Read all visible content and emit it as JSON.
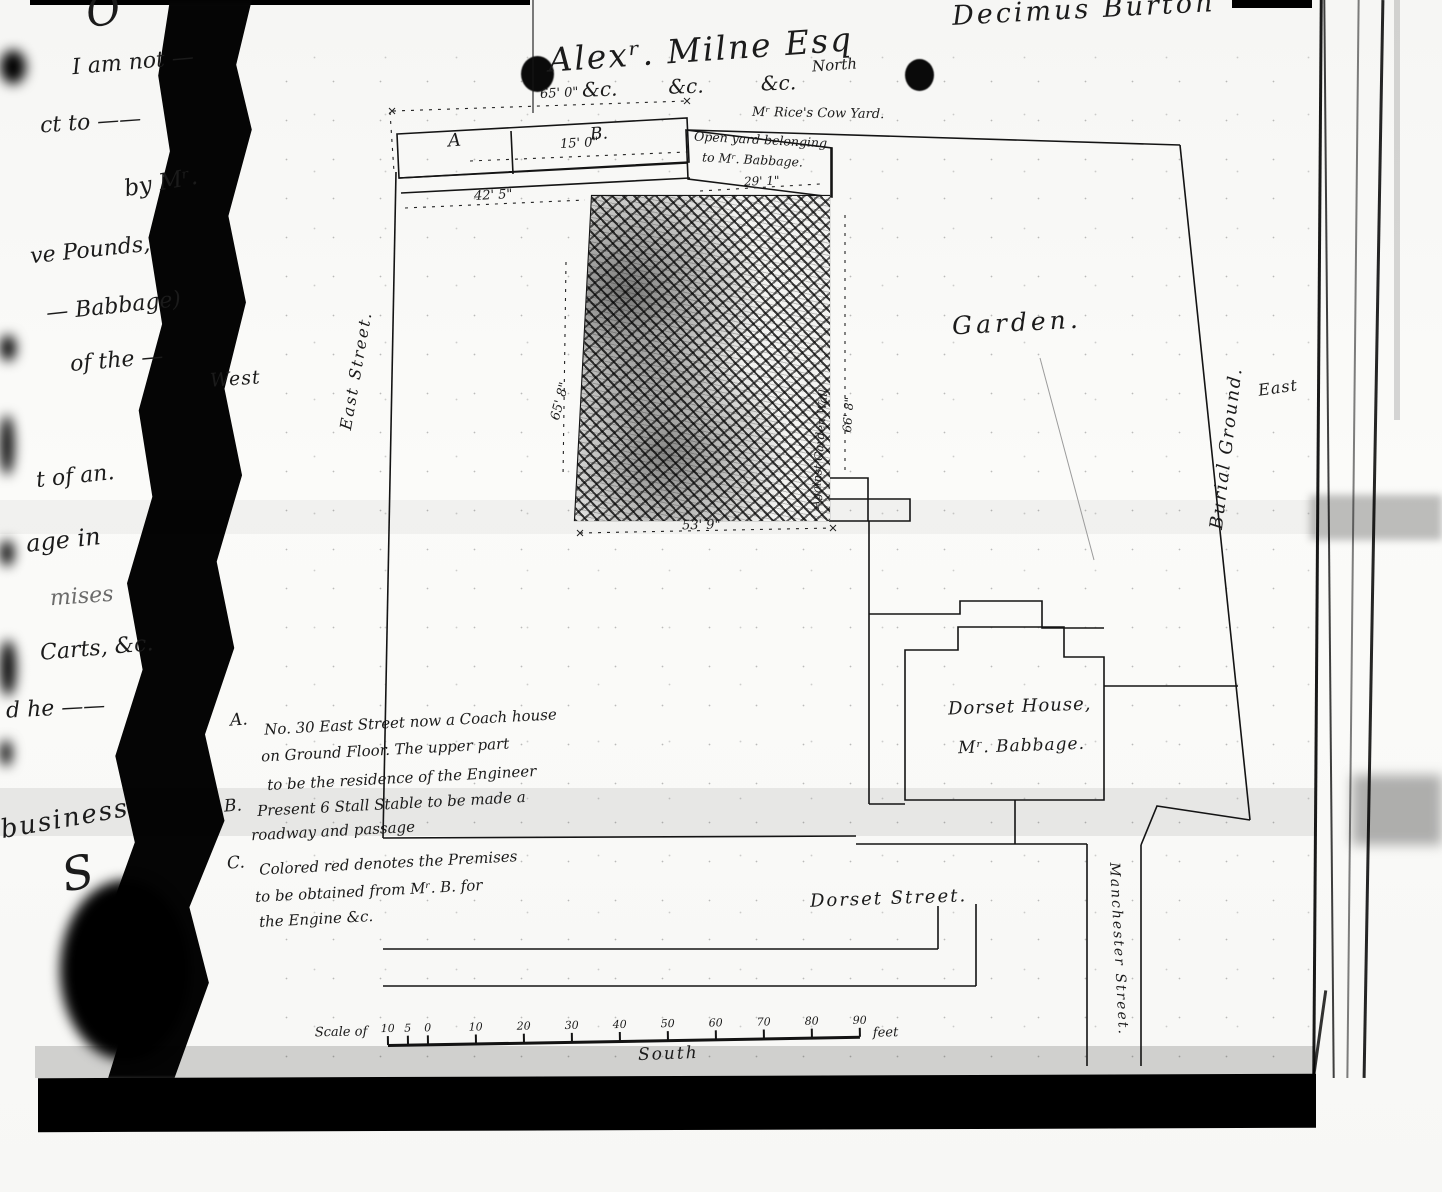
{
  "page": {
    "heading_name": "Alexʳ. Milne Esq",
    "heading_ditto": "&c.        &c.         &c.",
    "signature": "Decimus Burton",
    "compass": {
      "north": "North",
      "south": "South",
      "east": "East",
      "west": "West"
    }
  },
  "margin_letter": {
    "fragments": [
      "I am not —",
      "ct  to ——",
      "by  Mʳ.",
      "ve  Pounds,",
      "— Babbage)",
      "of  the —",
      "t  of an.",
      "age  in",
      "mises",
      "Carts, &c.",
      "d   he  ——",
      "business"
    ],
    "flourish_top": "O",
    "flourish_bottom": "S"
  },
  "plan": {
    "streets": {
      "east_street": "East Street.",
      "dorset_street": "Dorset Street.",
      "manchester_street": "Manchester Street."
    },
    "areas": {
      "cow_yard": "Mʳ Rice's Cow Yard.",
      "open_yard_line1": "Open yard belonging",
      "open_yard_line2": "to Mʳ. Babbage.",
      "garden": "Garden.",
      "burial_ground": "Burial Ground.",
      "garden_wall": "Against Garden Wall",
      "dorset_house_line1": "Dorset House,",
      "dorset_house_line2": "Mʳ. Babbage.",
      "block_a": "A",
      "block_b": "B."
    },
    "dimensions": {
      "top_width": "65' 0\"",
      "stable_width": "15' 0\"",
      "parcel_width": "42' 5\"",
      "open_yard_width": "29' 1\"",
      "west_side": "65' 8\"",
      "east_side": "66' 8\"",
      "south_side": "53' 9\""
    },
    "notes": {
      "a_label": "A.",
      "a_lines": [
        "No. 30 East Street   now a Coach house",
        "on Ground Floor.    The upper part",
        "to be the residence  of  the  Engineer"
      ],
      "b_label": "B.",
      "b_lines": [
        "Present 6 Stall Stable  to be made a",
        "roadway and   passage"
      ],
      "c_label": "C.",
      "c_lines": [
        "Colored red  denotes  the  Premises",
        "to be obtained   from  Mʳ. B.  for",
        "the  Engine  &c."
      ]
    },
    "scale": {
      "prefix": "Scale of",
      "ticks": [
        "10",
        "5",
        "0",
        "10",
        "20",
        "30",
        "40",
        "50",
        "60",
        "70",
        "80",
        "90"
      ],
      "unit": "feet"
    }
  }
}
